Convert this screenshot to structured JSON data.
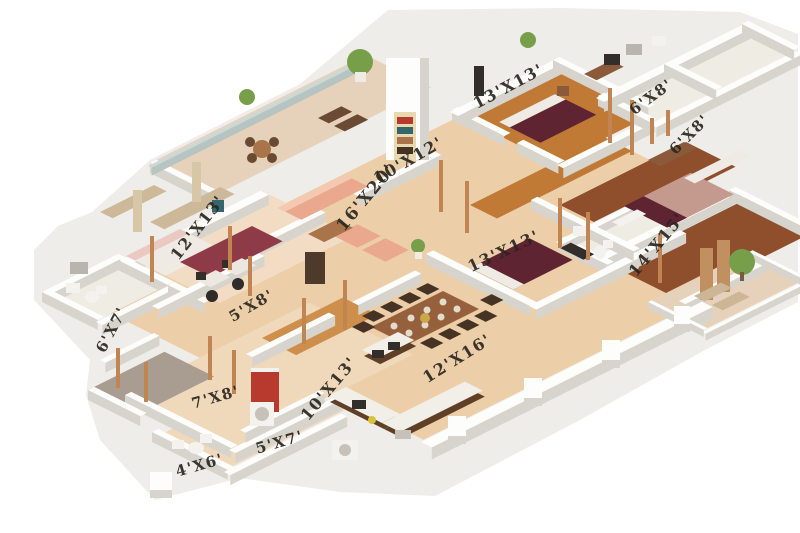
{
  "palette": {
    "background": "#ffffff",
    "base_shadow": "#efede9",
    "floor_tan": "#eccfa9",
    "floor_tan_light": "#f0d9ba",
    "floor_peach": "#f2dcc3",
    "floor_tile": "#e6d2ba",
    "floor_tile_white": "#efece4",
    "floor_gray": "#a89d90",
    "floor_wood": "#c07a35",
    "floor_wood_light": "#cf8f4c",
    "floor_wood_dark": "#8f4f2c",
    "wall_top": "#fdfdfb",
    "wall_face": "#d7d4cd",
    "glass": "#ccd8d6",
    "glass_face": "#b7c4c2",
    "bed_maroon": "#5f2431",
    "bed_white": "#f0eae4",
    "bed_pink": "#e9c9c1",
    "mattress_pink": "#c49a8e",
    "rug_maroon": "#8e3b47",
    "sofa_salmon": "#eaa98f",
    "sofa_light": "#f3c9b1",
    "wood_furniture": "#8a5a3a",
    "wood_mid": "#a9744a",
    "wood_mid2": "#96603c",
    "dark_wood": "#4e3a2b",
    "chair_dark": "#463323",
    "chair_brown": "#6a4a32",
    "chair_black": "#2e2b28",
    "dark_unit": "#322e2a",
    "pillar_copper": "#c08552",
    "plant_green": "#779f4a",
    "trunk_brown": "#7a5a3a",
    "accent_red": "#b8392e",
    "white_fix": "#f4f2ee",
    "sink_gray": "#c6c2b9",
    "counter_white": "#f2efe8",
    "cab_dark": "#5f4026",
    "wardrobe_beige": "#cdb999",
    "curtain_beige": "#d8c7a6",
    "teal_chair": "#33666d",
    "lounge_stripe": "#cdb695",
    "plate_white": "#e3dbcc",
    "gold": "#c8a84b",
    "slat_wood": "#c09060",
    "window_gray": "#b9b5ac",
    "flower_yellow": "#d8c23a",
    "desk_white": "#ece8e0",
    "shelf_cream": "#e8d9b0",
    "pot_white": "#efece6",
    "label_ink": "#2a2620"
  },
  "plan": {
    "labels": [
      {
        "id": "bedroom-top",
        "text": "13'X13'",
        "x": 511,
        "y": 91,
        "rot": -28,
        "size": 16
      },
      {
        "id": "closet-right-1",
        "text": "6'X8'",
        "x": 654,
        "y": 101,
        "rot": -36,
        "size": 15
      },
      {
        "id": "closet-right-2",
        "text": "6'X8'",
        "x": 693,
        "y": 138,
        "rot": -45,
        "size": 15
      },
      {
        "id": "foyer-area",
        "text": "10'X12'",
        "x": 411,
        "y": 165,
        "rot": -30,
        "size": 16
      },
      {
        "id": "living-room",
        "text": "16'X20'",
        "x": 370,
        "y": 201,
        "rot": -50,
        "size": 17
      },
      {
        "id": "bedroom-left",
        "text": "12'X13'",
        "x": 202,
        "y": 231,
        "rot": -52,
        "size": 16
      },
      {
        "id": "bedroom-right",
        "text": "14'X15'",
        "x": 661,
        "y": 248,
        "rot": -50,
        "size": 16
      },
      {
        "id": "bedroom-middle",
        "text": "13'X13'",
        "x": 506,
        "y": 256,
        "rot": -25,
        "size": 16
      },
      {
        "id": "study-nook",
        "text": "5'X8'",
        "x": 254,
        "y": 310,
        "rot": -30,
        "size": 15
      },
      {
        "id": "bath-west",
        "text": "6'X7'",
        "x": 116,
        "y": 332,
        "rot": -62,
        "size": 15
      },
      {
        "id": "utility-room",
        "text": "7'X8'",
        "x": 217,
        "y": 402,
        "rot": -16,
        "size": 15
      },
      {
        "id": "bath-bottom",
        "text": "4'X6'",
        "x": 201,
        "y": 470,
        "rot": -16,
        "size": 15
      },
      {
        "id": "hall-bottom",
        "text": "5'X7'",
        "x": 281,
        "y": 447,
        "rot": -16,
        "size": 15
      },
      {
        "id": "kitchen",
        "text": "10'X13'",
        "x": 333,
        "y": 392,
        "rot": -50,
        "size": 16
      },
      {
        "id": "dining-room",
        "text": "12'X16'",
        "x": 460,
        "y": 363,
        "rot": -32,
        "size": 16
      }
    ]
  }
}
